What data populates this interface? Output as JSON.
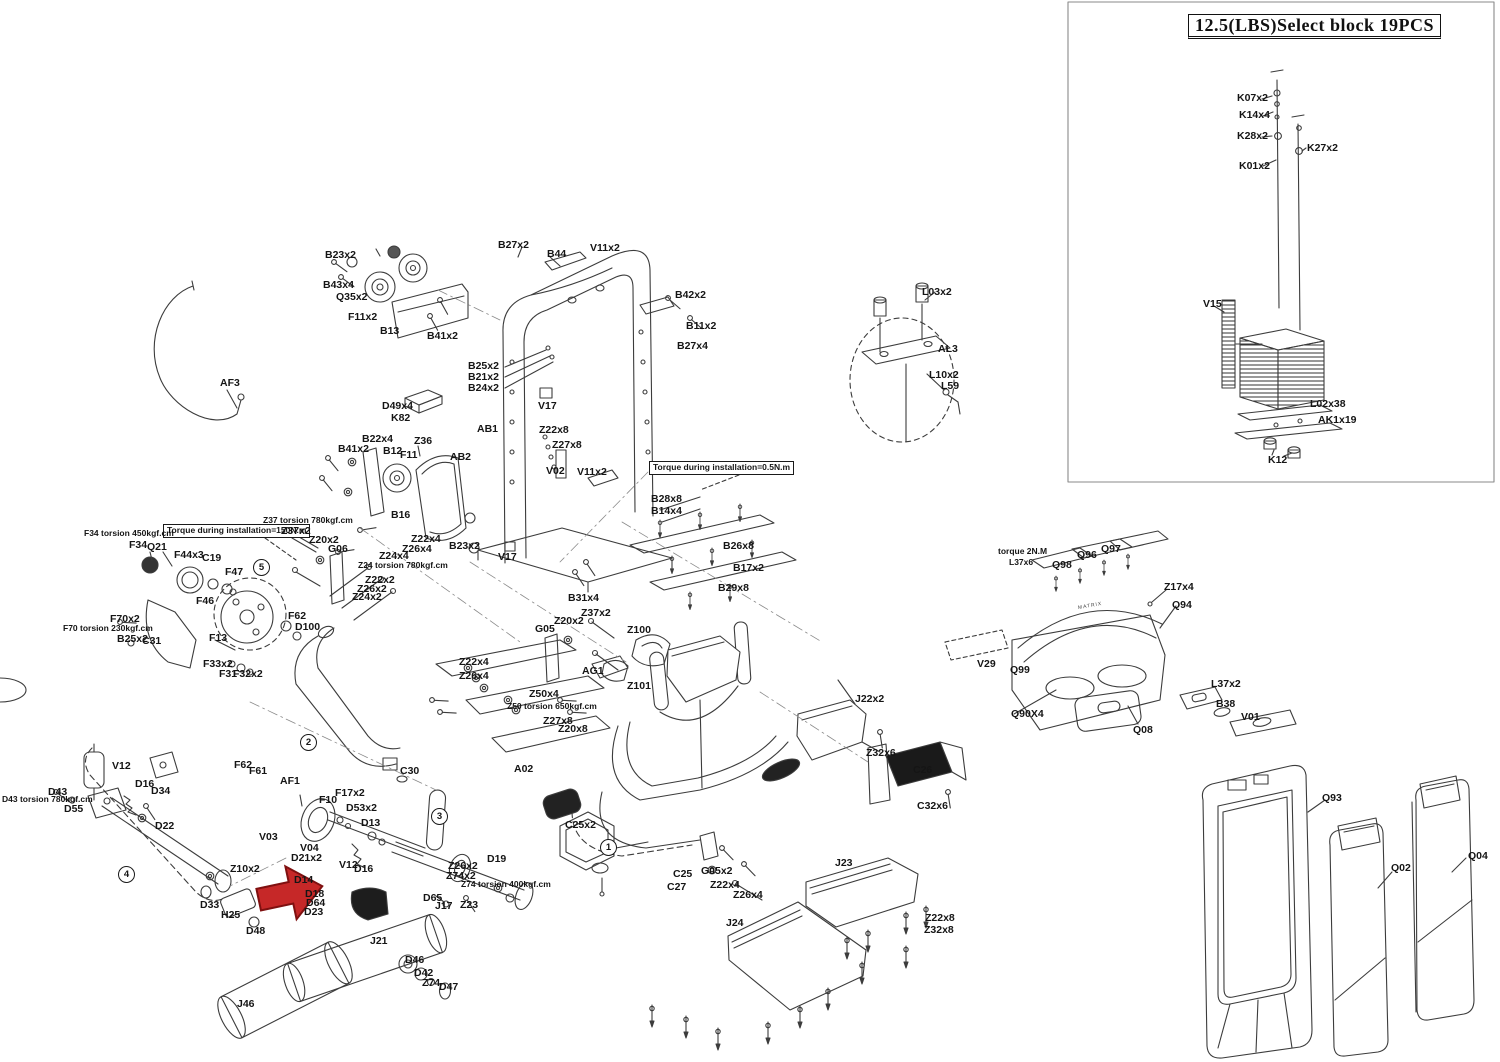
{
  "inset": {
    "title": "12.5(LBS)Select block 19PCS"
  },
  "brand": "MATRIX",
  "arrow": {
    "color": "#c62828"
  },
  "labels": [
    {
      "t": "K07x2",
      "x": 1237,
      "y": 93
    },
    {
      "t": "K14x4",
      "x": 1239,
      "y": 110
    },
    {
      "t": "K28x2",
      "x": 1237,
      "y": 131
    },
    {
      "t": "K27x2",
      "x": 1307,
      "y": 143
    },
    {
      "t": "K01x2",
      "x": 1239,
      "y": 161
    },
    {
      "t": "V15",
      "x": 1203,
      "y": 299
    },
    {
      "t": "L02x38",
      "x": 1310,
      "y": 399
    },
    {
      "t": "AK1x19",
      "x": 1318,
      "y": 415
    },
    {
      "t": "K12",
      "x": 1268,
      "y": 455
    },
    {
      "t": "B23x2",
      "x": 325,
      "y": 250
    },
    {
      "t": "B43x4",
      "x": 323,
      "y": 280
    },
    {
      "t": "Q35x2",
      "x": 336,
      "y": 292
    },
    {
      "t": "F11x2",
      "x": 348,
      "y": 312
    },
    {
      "t": "B13",
      "x": 380,
      "y": 326
    },
    {
      "t": "B41x2",
      "x": 427,
      "y": 331
    },
    {
      "t": "B27x2",
      "x": 498,
      "y": 240
    },
    {
      "t": "B44",
      "x": 547,
      "y": 249
    },
    {
      "t": "V11x2",
      "x": 590,
      "y": 243
    },
    {
      "t": "B42x2",
      "x": 675,
      "y": 290
    },
    {
      "t": "B11x2",
      "x": 686,
      "y": 321
    },
    {
      "t": "B27x4",
      "x": 677,
      "y": 341
    },
    {
      "t": "B25x2",
      "x": 468,
      "y": 361
    },
    {
      "t": "B21x2",
      "x": 468,
      "y": 372
    },
    {
      "t": "B24x2",
      "x": 468,
      "y": 383
    },
    {
      "t": "D49x4",
      "x": 382,
      "y": 401
    },
    {
      "t": "K82",
      "x": 391,
      "y": 413
    },
    {
      "t": "AB1",
      "x": 477,
      "y": 424
    },
    {
      "t": "V17",
      "x": 538,
      "y": 401
    },
    {
      "t": "Z22x8",
      "x": 539,
      "y": 425
    },
    {
      "t": "Z27x8",
      "x": 552,
      "y": 440
    },
    {
      "t": "V02",
      "x": 546,
      "y": 466
    },
    {
      "t": "V11x2",
      "x": 577,
      "y": 467
    },
    {
      "t": "B41x2",
      "x": 338,
      "y": 444
    },
    {
      "t": "B22x4",
      "x": 362,
      "y": 434
    },
    {
      "t": "B12",
      "x": 383,
      "y": 446
    },
    {
      "t": "F11",
      "x": 400,
      "y": 450
    },
    {
      "t": "Z36",
      "x": 414,
      "y": 436
    },
    {
      "t": "AB2",
      "x": 450,
      "y": 452
    },
    {
      "t": "B16",
      "x": 391,
      "y": 510
    },
    {
      "t": "B23x2",
      "x": 449,
      "y": 541
    },
    {
      "t": "V17",
      "x": 498,
      "y": 552
    },
    {
      "t": "Torque during installation=150N.m",
      "x": 163,
      "y": 524,
      "cls": "box"
    },
    {
      "t": "Torque during installation=0.5N.m",
      "x": 649,
      "y": 461,
      "cls": "box"
    },
    {
      "t": "F34 torsion 450kgf.cm",
      "x": 84,
      "y": 529,
      "cls": "note"
    },
    {
      "t": "F34",
      "x": 129,
      "y": 540
    },
    {
      "t": "Q21",
      "x": 147,
      "y": 542
    },
    {
      "t": "F44x3",
      "x": 174,
      "y": 550
    },
    {
      "t": "C19",
      "x": 202,
      "y": 553
    },
    {
      "t": "F47",
      "x": 225,
      "y": 567
    },
    {
      "t": "F46",
      "x": 196,
      "y": 596
    },
    {
      "t": "Z37 torsion 780kgf.cm",
      "x": 263,
      "y": 516,
      "cls": "note"
    },
    {
      "t": "Z37x2",
      "x": 281,
      "y": 526
    },
    {
      "t": "Z20x2",
      "x": 309,
      "y": 535
    },
    {
      "t": "G06",
      "x": 328,
      "y": 544
    },
    {
      "t": "F70x2",
      "x": 110,
      "y": 614
    },
    {
      "t": "F70 torsion 230kgf.cm",
      "x": 63,
      "y": 624,
      "cls": "note"
    },
    {
      "t": "B25x2",
      "x": 117,
      "y": 634
    },
    {
      "t": "C31",
      "x": 142,
      "y": 636
    },
    {
      "t": "F13",
      "x": 209,
      "y": 633
    },
    {
      "t": "F33x2",
      "x": 203,
      "y": 659
    },
    {
      "t": "F31",
      "x": 219,
      "y": 669
    },
    {
      "t": "F32x2",
      "x": 233,
      "y": 669
    },
    {
      "t": "F62",
      "x": 288,
      "y": 611
    },
    {
      "t": "D100",
      "x": 295,
      "y": 622
    },
    {
      "t": "Z22x4",
      "x": 411,
      "y": 534
    },
    {
      "t": "Z26x4",
      "x": 402,
      "y": 544
    },
    {
      "t": "Z24x4",
      "x": 379,
      "y": 551
    },
    {
      "t": "Z24 torsion 780kgf.cm",
      "x": 358,
      "y": 561,
      "cls": "note"
    },
    {
      "t": "Z22x2",
      "x": 365,
      "y": 575
    },
    {
      "t": "Z26x2",
      "x": 357,
      "y": 584
    },
    {
      "t": "Z24x2",
      "x": 352,
      "y": 592
    },
    {
      "t": "B31x4",
      "x": 568,
      "y": 593
    },
    {
      "t": "Z37x2",
      "x": 581,
      "y": 608
    },
    {
      "t": "Z20x2",
      "x": 554,
      "y": 616
    },
    {
      "t": "G05",
      "x": 535,
      "y": 624
    },
    {
      "t": "Z100",
      "x": 627,
      "y": 625
    },
    {
      "t": "AG1",
      "x": 582,
      "y": 666
    },
    {
      "t": "Z101",
      "x": 627,
      "y": 681
    },
    {
      "t": "Z22x4",
      "x": 459,
      "y": 657
    },
    {
      "t": "Z26x4",
      "x": 459,
      "y": 671
    },
    {
      "t": "Z50x4",
      "x": 529,
      "y": 689
    },
    {
      "t": "Z50 torsion 650kgf.cm",
      "x": 507,
      "y": 702,
      "cls": "note"
    },
    {
      "t": "Z27x8",
      "x": 543,
      "y": 716
    },
    {
      "t": "Z20x8",
      "x": 558,
      "y": 724
    },
    {
      "t": "A02",
      "x": 514,
      "y": 764
    },
    {
      "t": "C30",
      "x": 400,
      "y": 766
    },
    {
      "t": "B28x8",
      "x": 651,
      "y": 494
    },
    {
      "t": "B14x4",
      "x": 651,
      "y": 506
    },
    {
      "t": "B26x8",
      "x": 723,
      "y": 541
    },
    {
      "t": "B17x2",
      "x": 733,
      "y": 563
    },
    {
      "t": "B29x8",
      "x": 718,
      "y": 583
    },
    {
      "t": "L03x2",
      "x": 922,
      "y": 287
    },
    {
      "t": "AL3",
      "x": 938,
      "y": 344
    },
    {
      "t": "L10x2",
      "x": 929,
      "y": 370
    },
    {
      "t": "L59",
      "x": 941,
      "y": 381
    },
    {
      "t": "J22x2",
      "x": 855,
      "y": 694
    },
    {
      "t": "Z32x6",
      "x": 866,
      "y": 748
    },
    {
      "t": "C26",
      "x": 913,
      "y": 765
    },
    {
      "t": "C32x6",
      "x": 917,
      "y": 801
    },
    {
      "t": "J23",
      "x": 835,
      "y": 858
    },
    {
      "t": "J24",
      "x": 726,
      "y": 918
    },
    {
      "t": "Z22x8",
      "x": 925,
      "y": 913
    },
    {
      "t": "Z32x8",
      "x": 924,
      "y": 925
    },
    {
      "t": "C25x2",
      "x": 565,
      "y": 820
    },
    {
      "t": "C25",
      "x": 673,
      "y": 869
    },
    {
      "t": "C27",
      "x": 667,
      "y": 882
    },
    {
      "t": "G05x2",
      "x": 701,
      "y": 866
    },
    {
      "t": "Z22x4",
      "x": 710,
      "y": 880
    },
    {
      "t": "Z26x4",
      "x": 733,
      "y": 890
    },
    {
      "t": "torque 2N.M",
      "x": 998,
      "y": 547,
      "cls": "note"
    },
    {
      "t": "L37x6",
      "x": 1009,
      "y": 558,
      "cls": "note"
    },
    {
      "t": "Q98",
      "x": 1052,
      "y": 560
    },
    {
      "t": "Q96",
      "x": 1077,
      "y": 550
    },
    {
      "t": "Q97",
      "x": 1101,
      "y": 544
    },
    {
      "t": "Z17x4",
      "x": 1164,
      "y": 582
    },
    {
      "t": "Q94",
      "x": 1172,
      "y": 600
    },
    {
      "t": "V29",
      "x": 977,
      "y": 659
    },
    {
      "t": "Q99",
      "x": 1010,
      "y": 665
    },
    {
      "t": "Q90X4",
      "x": 1011,
      "y": 709
    },
    {
      "t": "Q08",
      "x": 1133,
      "y": 725
    },
    {
      "t": "L37x2",
      "x": 1211,
      "y": 679
    },
    {
      "t": "B38",
      "x": 1216,
      "y": 699
    },
    {
      "t": "V01",
      "x": 1241,
      "y": 712
    },
    {
      "t": "Q93",
      "x": 1322,
      "y": 793
    },
    {
      "t": "Q02",
      "x": 1391,
      "y": 863
    },
    {
      "t": "Q04",
      "x": 1468,
      "y": 851
    },
    {
      "t": "V12",
      "x": 112,
      "y": 761
    },
    {
      "t": "D16",
      "x": 135,
      "y": 779
    },
    {
      "t": "D34",
      "x": 151,
      "y": 786
    },
    {
      "t": "D43",
      "x": 48,
      "y": 787
    },
    {
      "t": "D43 torsion 780kgf.cm",
      "x": 2,
      "y": 795,
      "cls": "note"
    },
    {
      "t": "D55",
      "x": 64,
      "y": 804
    },
    {
      "t": "D22",
      "x": 155,
      "y": 821
    },
    {
      "t": "Z10x2",
      "x": 230,
      "y": 864
    },
    {
      "t": "D33",
      "x": 200,
      "y": 900
    },
    {
      "t": "H25",
      "x": 221,
      "y": 910
    },
    {
      "t": "D48",
      "x": 246,
      "y": 926
    },
    {
      "t": "F62",
      "x": 234,
      "y": 760
    },
    {
      "t": "F61",
      "x": 249,
      "y": 766
    },
    {
      "t": "AF1",
      "x": 280,
      "y": 776
    },
    {
      "t": "V03",
      "x": 259,
      "y": 832
    },
    {
      "t": "AF3",
      "x": 220,
      "y": 378
    },
    {
      "t": "F10",
      "x": 319,
      "y": 795
    },
    {
      "t": "F17x2",
      "x": 335,
      "y": 788
    },
    {
      "t": "D53x2",
      "x": 346,
      "y": 803
    },
    {
      "t": "D13",
      "x": 361,
      "y": 818
    },
    {
      "t": "V04",
      "x": 300,
      "y": 843
    },
    {
      "t": "D21x2",
      "x": 291,
      "y": 853
    },
    {
      "t": "V12",
      "x": 339,
      "y": 860
    },
    {
      "t": "D16",
      "x": 354,
      "y": 864
    },
    {
      "t": "D14",
      "x": 294,
      "y": 875
    },
    {
      "t": "D18",
      "x": 305,
      "y": 889
    },
    {
      "t": "D64",
      "x": 306,
      "y": 898
    },
    {
      "t": "D23",
      "x": 304,
      "y": 907
    },
    {
      "t": "D19",
      "x": 487,
      "y": 854
    },
    {
      "t": "Z26x2",
      "x": 448,
      "y": 861
    },
    {
      "t": "Z74x2",
      "x": 446,
      "y": 871
    },
    {
      "t": "Z74 torsion 400kgf.cm",
      "x": 461,
      "y": 880,
      "cls": "note"
    },
    {
      "t": "D65",
      "x": 423,
      "y": 893
    },
    {
      "t": "J17",
      "x": 435,
      "y": 901
    },
    {
      "t": "Z23",
      "x": 460,
      "y": 900
    },
    {
      "t": "J21",
      "x": 370,
      "y": 936
    },
    {
      "t": "D46",
      "x": 405,
      "y": 955
    },
    {
      "t": "D42",
      "x": 414,
      "y": 968
    },
    {
      "t": "Z74",
      "x": 422,
      "y": 978
    },
    {
      "t": "D47",
      "x": 439,
      "y": 982
    },
    {
      "t": "J46",
      "x": 237,
      "y": 999
    },
    {
      "t": "1",
      "x": 600,
      "y": 839,
      "cls": "circ"
    },
    {
      "t": "2",
      "x": 300,
      "y": 734,
      "cls": "circ"
    },
    {
      "t": "3",
      "x": 431,
      "y": 808,
      "cls": "circ"
    },
    {
      "t": "4",
      "x": 118,
      "y": 866,
      "cls": "circ"
    },
    {
      "t": "5",
      "x": 253,
      "y": 559,
      "cls": "circ"
    }
  ]
}
